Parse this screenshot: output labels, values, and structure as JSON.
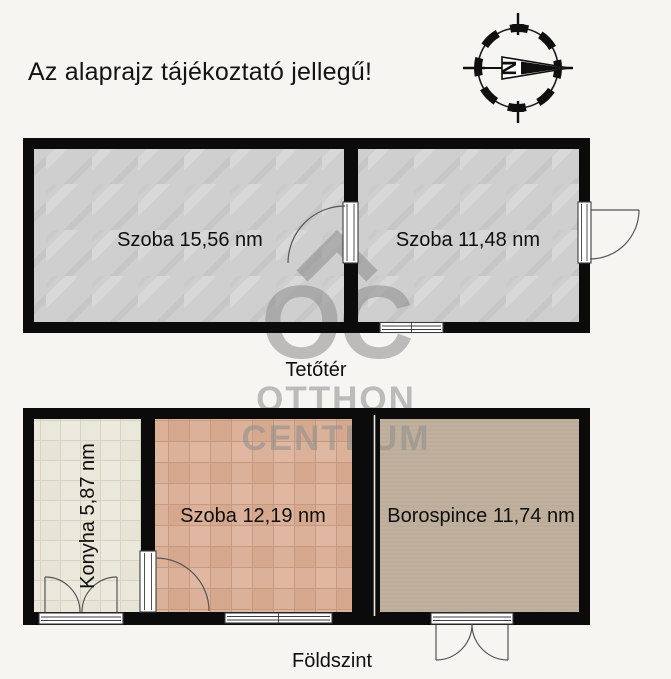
{
  "title": {
    "text": "Az alaprajz tájékoztató jellegű!"
  },
  "compass": {
    "north_label": "N"
  },
  "floors": [
    {
      "id": "tetoter",
      "label": "Tetőtér",
      "rooms": [
        {
          "label": "Szoba 15,56 nm",
          "area_nm": "15,56",
          "floor_finish": "concrete-gray"
        },
        {
          "label": "Szoba 11,48 nm",
          "area_nm": "11,48",
          "floor_finish": "concrete-gray"
        }
      ]
    },
    {
      "id": "foldszint",
      "label": "Földszint",
      "rooms": [
        {
          "label": "Konyha 5,87 nm",
          "area_nm": "5,87",
          "floor_finish": "light-tile"
        },
        {
          "label": "Szoba 12,19 nm",
          "area_nm": "12,19",
          "floor_finish": "terracotta-tile"
        },
        {
          "label": "Borospince 11,74 nm",
          "area_nm": "11,74",
          "floor_finish": "brown-weave"
        }
      ]
    }
  ],
  "watermark": {
    "monogram": "OC",
    "brand_top": "OTTHON",
    "brand_bottom": "CENTRUM"
  },
  "colors": {
    "background": "#f6f5f2",
    "wall": "#0b0b0b",
    "gray_floor": "#cfcfcf",
    "terracotta_tile": "#dcb199",
    "kitchen_tile": "#eae7db",
    "cellar_floor": "#c0b19e",
    "watermark_gray": "#8d8d8d"
  }
}
